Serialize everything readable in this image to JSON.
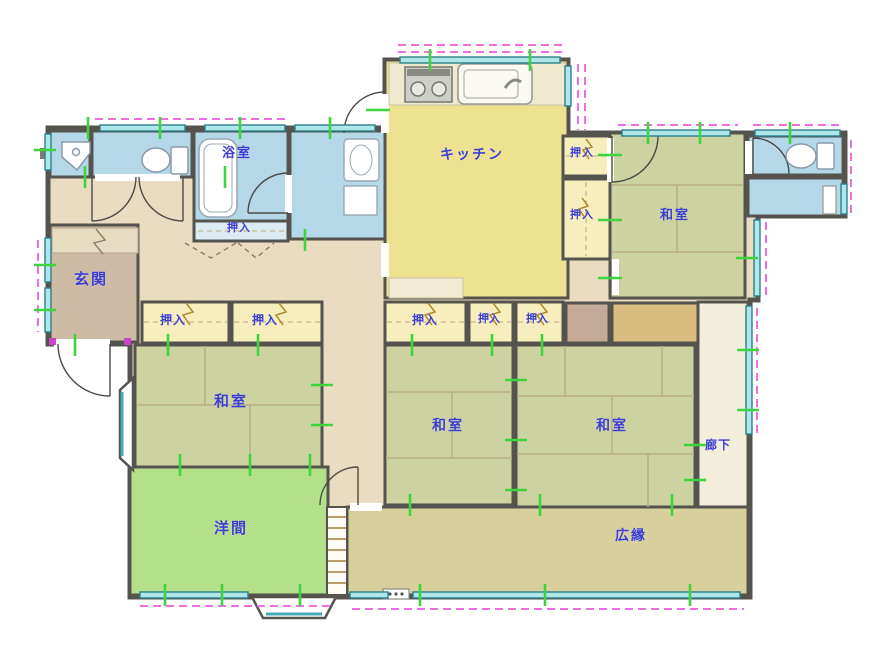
{
  "plan": {
    "type": "floor-plan",
    "language": "ja",
    "rooms": [
      {
        "id": "bathroom",
        "label": "浴室"
      },
      {
        "id": "kitchen",
        "label": "キッチン"
      },
      {
        "id": "closet-kitchen-upper",
        "label": "押入"
      },
      {
        "id": "closet-kitchen-lower",
        "label": "押入"
      },
      {
        "id": "washitsu-northeast",
        "label": "和室"
      },
      {
        "id": "closet-bath",
        "label": "押入"
      },
      {
        "id": "genkan",
        "label": "玄関"
      },
      {
        "id": "closet-west-a",
        "label": "押入"
      },
      {
        "id": "closet-west-b",
        "label": "押入"
      },
      {
        "id": "closet-center-a",
        "label": "押入"
      },
      {
        "id": "closet-center-b",
        "label": "押入"
      },
      {
        "id": "closet-center-c",
        "label": "押入"
      },
      {
        "id": "washitsu-west",
        "label": "和室"
      },
      {
        "id": "washitsu-center",
        "label": "和室"
      },
      {
        "id": "washitsu-southeast",
        "label": "和室"
      },
      {
        "id": "rouka",
        "label": "廊下"
      },
      {
        "id": "yoma",
        "label": "洋間"
      },
      {
        "id": "hiroen",
        "label": "広縁"
      }
    ],
    "icons": {
      "toilet": "toilet-icon",
      "bathtub": "bathtub-icon",
      "washbasin": "washbasin-icon",
      "kitchen_sink": "kitchen-sink-icon",
      "stove": "stove-icon",
      "washer_cabinet": "washer-cabinet-icon"
    },
    "colors": {
      "wall": "#55534d",
      "wet_room": "#b5d8e8",
      "kitchen": "#ece28f",
      "closet": "#f6eebd",
      "tatami": "#ccd3a0",
      "western_room": "#b4e08c",
      "veranda": "#d7d09d",
      "hallway": "#e9dcc1",
      "entrance": "#cdbba6",
      "corridor": "#f3eedb",
      "window": "#aee6ea",
      "dimension": "#ef6fe0",
      "tick": "#3ed43e",
      "label": "#3d3dd2",
      "tokonoma": "#d9bc80"
    }
  }
}
